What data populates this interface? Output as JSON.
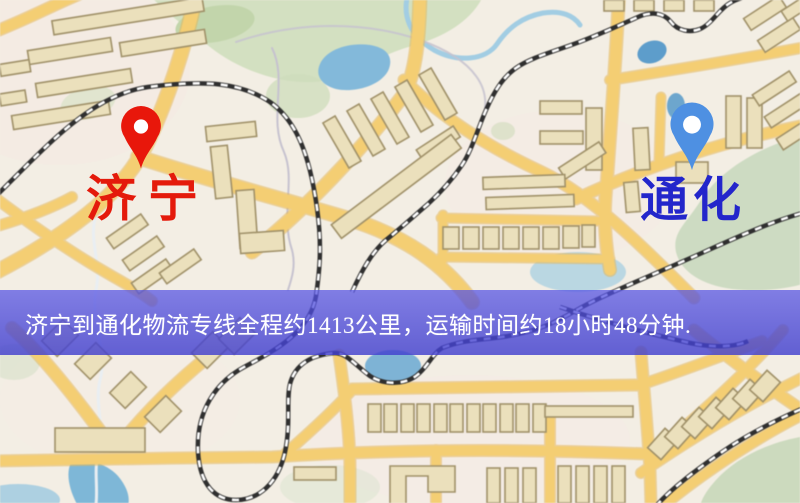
{
  "banner": {
    "text": "济宁到通化物流专线全程约1413公里，运输时间约18小时48分钟."
  },
  "route": {
    "from": "济宁",
    "to": "通化",
    "distance_text": "约1413公里",
    "duration_text": "约18小时48分钟"
  },
  "markers": {
    "origin": {
      "label": "济宁",
      "pin_color": "#e8170b",
      "label_color": "#e41a0b",
      "pin_icon": "red-location-pin-icon"
    },
    "destination": {
      "label": "通化",
      "pin_color": "#4e90e2",
      "label_color": "#2326cb",
      "pin_icon": "blue-location-pin-icon"
    }
  },
  "map_colors": {
    "background": "#f3eee4",
    "road": "#f3ce76",
    "road_edge": "#e2b75c",
    "building_fill": "#ebe0bd",
    "building_stroke": "#a0916a",
    "park_green": "#d3e0c2",
    "water_blue": "#84b9d9",
    "railway_dark": "#2f2f2f",
    "trail": "#c6c2cf",
    "banner_overlay": "#4d4ade"
  }
}
